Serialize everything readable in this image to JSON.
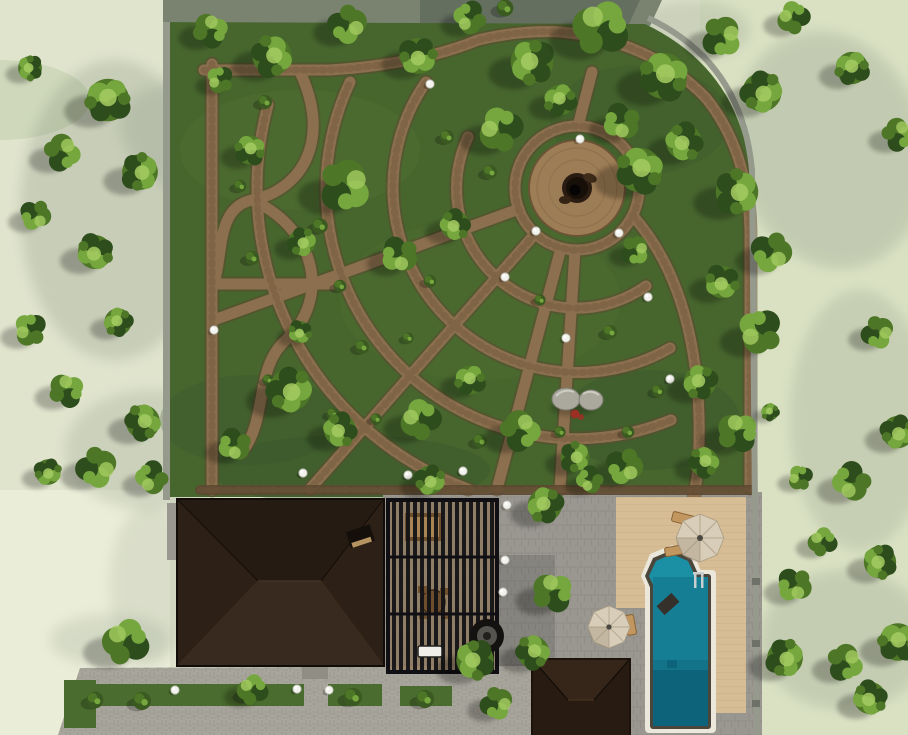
{
  "colors": {
    "bg_left": "#e0e4cd",
    "bg_right": "#d9e0c2",
    "bg_corner": "#ebeed9",
    "shadow": "#8e9a88",
    "courtyard": "#798370",
    "courtyard_shade": "#5f6a5c",
    "lawn": "#47662e",
    "lawn_light": "#5c8038",
    "lawn_dark": "#34502a",
    "path_stone": "#8b6f4e",
    "path_edge": "#5d4831",
    "path_dash": "#6e5539",
    "plaza_stone": "#9d7d55",
    "boundary_wall": "#969a8d",
    "roof_north": "#261b13",
    "roof_south": "#382a1e",
    "roof_side": "#2d2016",
    "roof_edge": "#120c08",
    "paver": "#999790",
    "paver_line": "#7e7c73",
    "driveway": "#a8a69c",
    "deck": "#d7bd95",
    "deck_line": "#bfa276",
    "pool": "#157e95",
    "pool_deep": "#0c6175",
    "spa": "#1b8fa4",
    "coping": "#ebe7db",
    "pool_rim": "#4a463c",
    "pergola_dark": "#17171b",
    "pergola_wood": "#8a6a43",
    "furn_wood": "#6f4e2e",
    "umbrella": "#d8cdb8",
    "umbrella_seam": "#b3a68e",
    "shed_top": "#36261a",
    "shed_side": "#281c12",
    "shed_dark": "#1d130c",
    "tree_dark": "#2e4d1d",
    "tree_mid": "#4d7627",
    "tree_light": "#76a73e",
    "tree_hi": "#a4cc62",
    "bush": "#3a5a21",
    "lamp": "#f3f3ee",
    "rock": "#aba99e",
    "rock_dark": "#8f8d83",
    "flower": "#9c2f23",
    "firepit": "#141210",
    "grass_strip": "#4a6c2e",
    "metal": "#c9ced0"
  },
  "scene": {
    "trees": [
      [
        108,
        100,
        1.25,
        "a"
      ],
      [
        62,
        152,
        0.95,
        "b"
      ],
      [
        140,
        172,
        1.05,
        "a"
      ],
      [
        36,
        215,
        0.8,
        "b"
      ],
      [
        95,
        252,
        1.0,
        "a"
      ],
      [
        30,
        330,
        0.85,
        "b"
      ],
      [
        118,
        322,
        0.8,
        "a"
      ],
      [
        66,
        390,
        0.9,
        "b"
      ],
      [
        143,
        422,
        1.0,
        "a"
      ],
      [
        97,
        467,
        1.05,
        "b"
      ],
      [
        48,
        472,
        0.75,
        "a"
      ],
      [
        152,
        478,
        0.85,
        "b"
      ],
      [
        30,
        68,
        0.7,
        "a"
      ],
      [
        125,
        642,
        1.2,
        "b"
      ],
      [
        210,
        30,
        0.9,
        "b"
      ],
      [
        272,
        56,
        1.15,
        "a"
      ],
      [
        348,
        24,
        1.0,
        "b"
      ],
      [
        418,
        56,
        1.05,
        "a"
      ],
      [
        470,
        18,
        0.85,
        "b"
      ],
      [
        532,
        62,
        1.25,
        "a"
      ],
      [
        600,
        28,
        1.45,
        "b"
      ],
      [
        664,
        76,
        1.35,
        "a"
      ],
      [
        722,
        36,
        1.05,
        "b"
      ],
      [
        762,
        92,
        1.15,
        "a"
      ],
      [
        622,
        122,
        0.95,
        "b"
      ],
      [
        684,
        142,
        1.05,
        "a"
      ],
      [
        793,
        18,
        0.85,
        "b"
      ],
      [
        852,
        68,
        0.95,
        "a"
      ],
      [
        898,
        134,
        0.85,
        "b"
      ],
      [
        737,
        192,
        1.25,
        "a"
      ],
      [
        772,
        252,
        1.05,
        "b"
      ],
      [
        722,
        282,
        0.95,
        "a"
      ],
      [
        760,
        332,
        1.15,
        "b"
      ],
      [
        700,
        382,
        0.95,
        "a"
      ],
      [
        737,
        432,
        1.05,
        "b"
      ],
      [
        704,
        462,
        0.85,
        "a"
      ],
      [
        878,
        332,
        0.85,
        "b"
      ],
      [
        898,
        432,
        0.95,
        "a"
      ],
      [
        852,
        482,
        1.0,
        "b"
      ],
      [
        880,
        562,
        0.95,
        "a"
      ],
      [
        822,
        542,
        0.75,
        "b"
      ],
      [
        898,
        642,
        1.1,
        "a"
      ],
      [
        845,
        662,
        0.95,
        "b"
      ],
      [
        785,
        658,
        1.05,
        "a"
      ],
      [
        795,
        585,
        0.9,
        "b"
      ],
      [
        870,
        698,
        0.95,
        "a"
      ],
      [
        800,
        478,
        0.65,
        "b"
      ],
      [
        770,
        412,
        0.5,
        "a"
      ],
      [
        250,
        150,
        0.85,
        "a"
      ],
      [
        345,
        185,
        1.35,
        "b"
      ],
      [
        302,
        242,
        0.8,
        "a"
      ],
      [
        400,
        255,
        0.95,
        "b"
      ],
      [
        455,
        225,
        0.85,
        "a"
      ],
      [
        500,
        130,
        1.15,
        "b"
      ],
      [
        560,
        100,
        0.9,
        "a"
      ],
      [
        640,
        170,
        1.3,
        "a"
      ],
      [
        635,
        250,
        0.75,
        "b"
      ],
      [
        290,
        390,
        1.25,
        "a"
      ],
      [
        235,
        445,
        0.85,
        "b"
      ],
      [
        340,
        430,
        0.95,
        "a"
      ],
      [
        420,
        420,
        1.05,
        "b"
      ],
      [
        470,
        380,
        0.85,
        "a"
      ],
      [
        520,
        430,
        1.05,
        "b"
      ],
      [
        575,
        457,
        0.85,
        "a"
      ],
      [
        625,
        466,
        0.95,
        "b"
      ],
      [
        300,
        332,
        0.65,
        "a"
      ],
      [
        220,
        80,
        0.7,
        "b"
      ],
      [
        545,
        505,
        1.0,
        "a"
      ],
      [
        552,
        592,
        1.05,
        "b"
      ],
      [
        533,
        652,
        0.95,
        "a"
      ],
      [
        497,
        703,
        0.85,
        "b"
      ],
      [
        430,
        480,
        0.85,
        "a"
      ],
      [
        590,
        480,
        0.7,
        "b"
      ],
      [
        475,
        660,
        1.1,
        "a"
      ],
      [
        252,
        690,
        0.8,
        "b"
      ]
    ],
    "bushes": [
      [
        265,
        102,
        1.0
      ],
      [
        240,
        186,
        0.9
      ],
      [
        252,
        258,
        1.0
      ],
      [
        320,
        226,
        1.1
      ],
      [
        340,
        286,
        0.9
      ],
      [
        300,
        330,
        0.8
      ],
      [
        362,
        347,
        1.0
      ],
      [
        430,
        281,
        0.9
      ],
      [
        408,
        338,
        0.8
      ],
      [
        490,
        172,
        1.0
      ],
      [
        540,
        300,
        0.8
      ],
      [
        610,
        332,
        1.0
      ],
      [
        658,
        391,
        0.9
      ],
      [
        628,
        432,
        0.9
      ],
      [
        560,
        432,
        0.8
      ],
      [
        480,
        441,
        1.0
      ],
      [
        376,
        419,
        0.8
      ],
      [
        333,
        414,
        0.9
      ],
      [
        268,
        380,
        0.8
      ],
      [
        447,
        137,
        1.0
      ],
      [
        95,
        700,
        1.2
      ],
      [
        142,
        701,
        1.3
      ],
      [
        247,
        694,
        1.2
      ],
      [
        353,
        697,
        1.3
      ],
      [
        425,
        699,
        1.3
      ],
      [
        505,
        8,
        1.2
      ]
    ],
    "lamps": [
      [
        580,
        139
      ],
      [
        536,
        231
      ],
      [
        619,
        233
      ],
      [
        505,
        277
      ],
      [
        648,
        297
      ],
      [
        566,
        338
      ],
      [
        214,
        330
      ],
      [
        430,
        84
      ],
      [
        303,
        473
      ],
      [
        408,
        475
      ],
      [
        463,
        471
      ],
      [
        670,
        379
      ],
      [
        507,
        505
      ],
      [
        505,
        560
      ],
      [
        503,
        592
      ],
      [
        175,
        690
      ],
      [
        297,
        689
      ],
      [
        329,
        690
      ]
    ],
    "ground_shadows": [
      [
        115,
        210,
        95,
        150,
        0,
        0.3
      ],
      [
        225,
        150,
        110,
        60,
        20,
        0.28
      ],
      [
        150,
        450,
        85,
        60,
        0,
        0.25
      ],
      [
        830,
        150,
        95,
        120,
        -15,
        0.3
      ],
      [
        860,
        420,
        70,
        130,
        0,
        0.26
      ],
      [
        845,
        640,
        85,
        70,
        0,
        0.28
      ],
      [
        690,
        30,
        60,
        30,
        0,
        0.25
      ],
      [
        110,
        640,
        60,
        26,
        0,
        0.22
      ],
      [
        150,
        585,
        40,
        80,
        0,
        0.18
      ],
      [
        540,
        560,
        40,
        90,
        0,
        0.18
      ],
      [
        430,
        580,
        50,
        60,
        0,
        0.15
      ]
    ],
    "planting_strips": [
      [
        78,
        684,
        226,
        22
      ],
      [
        328,
        684,
        54,
        22
      ],
      [
        400,
        686,
        52,
        20
      ],
      [
        64,
        680,
        32,
        48
      ]
    ]
  }
}
